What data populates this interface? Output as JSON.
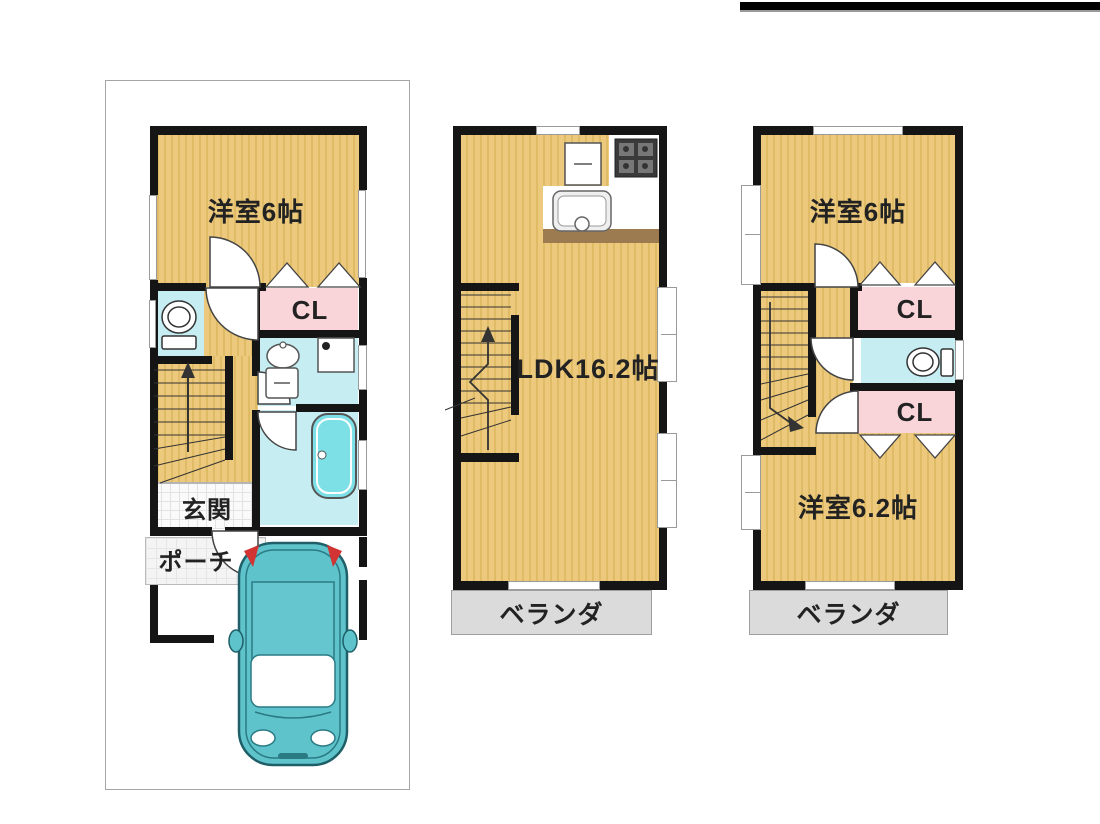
{
  "document": {
    "type": "japanese-house-floor-plan",
    "floor_count": 3
  },
  "floors": {
    "floor1": {
      "bedroom": "洋室6帖",
      "closet": "CL",
      "entrance": "玄関",
      "porch": "ポーチ"
    },
    "floor2": {
      "ldk": "LDK16.2帖",
      "veranda": "ベランダ"
    },
    "floor3": {
      "bedroom_front": "洋室6帖",
      "closet1": "CL",
      "closet2": "CL",
      "bedroom_back": "洋室6.2帖",
      "veranda": "ベランダ"
    }
  },
  "icons": {
    "car": "top-view-car",
    "toilet": "toilet-top-view",
    "bathtub": "bathtub-top-view",
    "washbasin": "oval-sink",
    "kitchen_sink": "counter-sink",
    "stove": "gas-stove-4-burner",
    "refrigerator": "refrigerator-square",
    "washing_machine": "washing-machine-square",
    "stairs": "staircase-with-arrow",
    "door": "swing-door-arc",
    "closet_door": "accordion-folding-door"
  },
  "colors": {
    "tatami_floor": "#ecc97c",
    "tatami_stripe": "#e0bb66",
    "wall": "#151515",
    "water_room": "#c6eef2",
    "closet": "#f9d5d9",
    "veranda": "#dbdbdb",
    "kitchen_counter": "#9c7b50",
    "car_body": "#5fc3cc",
    "car_tail_light": "#d23333",
    "bathtub_fill": "#7de0e6",
    "top_bar": "#000000"
  }
}
